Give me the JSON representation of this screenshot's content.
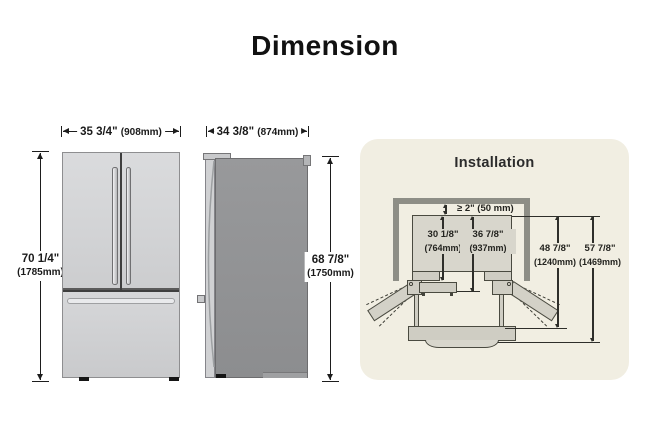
{
  "title": "Dimension",
  "front_view": {
    "width_in": "35 3/4\"",
    "width_mm": "(908mm)",
    "height_in": "70 1/4\"",
    "height_mm": "(1785mm)"
  },
  "side_view": {
    "depth_in": "34 3/8\"",
    "depth_mm": "(874mm)",
    "height_in": "68 7/8\"",
    "height_mm": "(1750mm)"
  },
  "installation": {
    "title": "Installation",
    "clearance": "≥ 2\" (50 mm)",
    "depth_no_door_in": "30 1/8\"",
    "depth_no_door_mm": "(764mm)",
    "depth_with_door_in": "36 7/8\"",
    "depth_with_door_mm": "(937mm)",
    "depth_drawer_open_in": "48 7/8\"",
    "depth_drawer_open_mm": "(1240mm)",
    "depth_door_open_in": "57 7/8\"",
    "depth_door_open_mm": "(1469mm)"
  },
  "colors": {
    "panel_bg": "#f1eee2",
    "wall": "#8e8e86",
    "fridge_light": "#d3d4d6",
    "fridge_dark": "#8f9092",
    "top_view_fill": "#d8d6cc",
    "line": "#1d1d1d"
  }
}
